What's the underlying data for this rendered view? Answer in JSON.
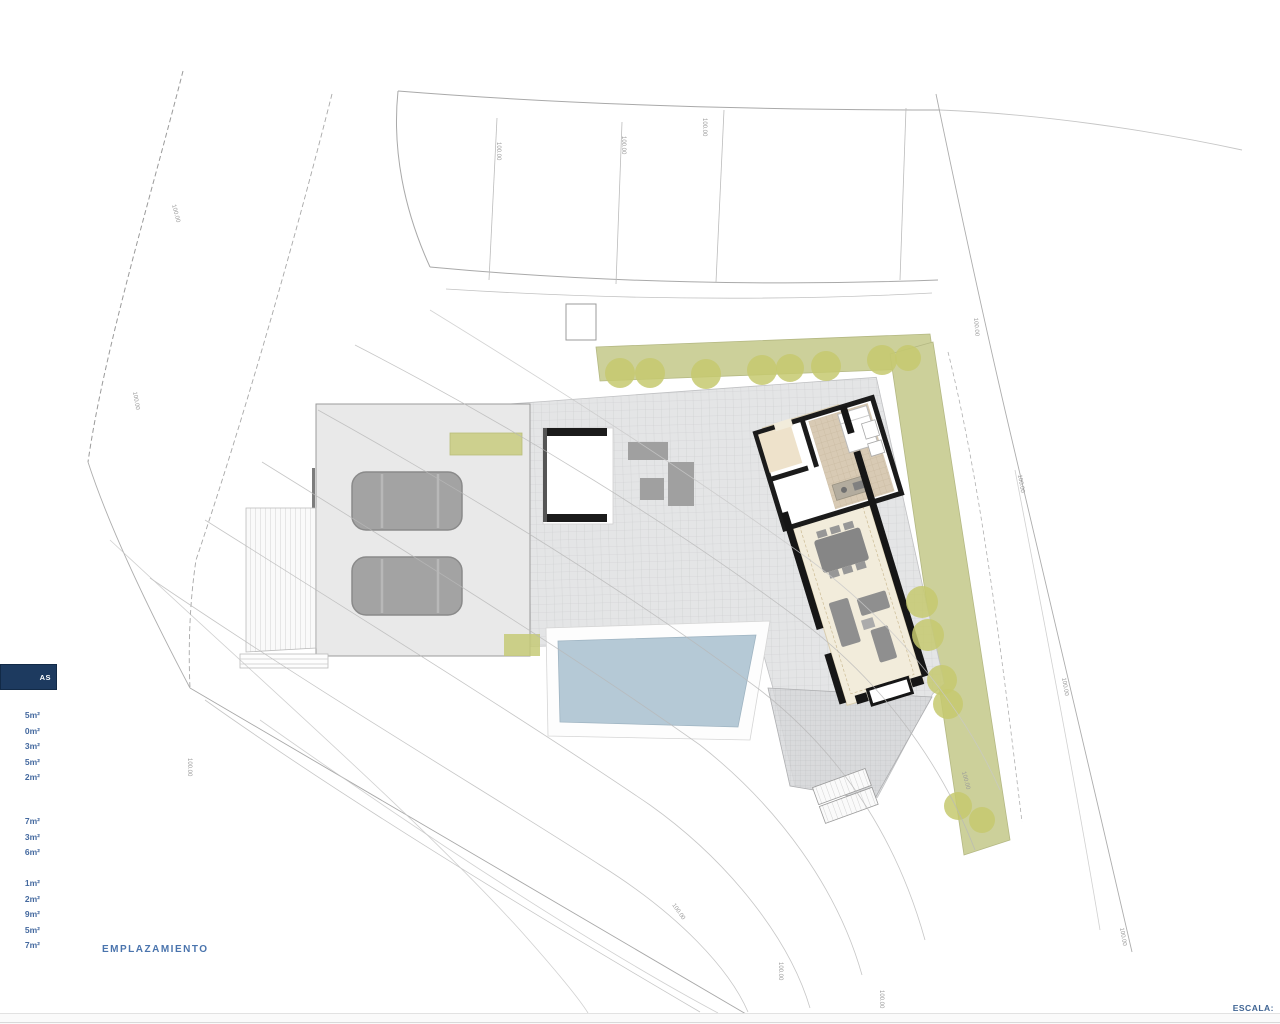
{
  "legend": {
    "title": "AS",
    "groups": [
      {
        "rows": [
          "5m²",
          "0m²",
          "3m²",
          "5m²",
          "2m²"
        ]
      },
      {
        "rows": [
          "7m²",
          "3m²",
          "6m²"
        ]
      },
      {
        "rows": [
          "1m²",
          "2m²",
          "9m²",
          "5m²",
          "7m²"
        ]
      }
    ]
  },
  "labels": {
    "plan_title": "EMPLAZAMIENTO",
    "scale": "ESCALA:"
  },
  "site": {
    "elevation_label": "100.00"
  },
  "colors": {
    "legend_navy": "#1d3a5f",
    "label_blue": "#4a74ad",
    "pool_blue": "#b5c9d6",
    "garden_green": "#ccd09a",
    "tree_olive": "#c5c96e",
    "terrace_cream": "#f2ecdb",
    "kitchen_tan": "#d8cab4",
    "wall_black": "#161616",
    "plaza_gray": "#e4e5e6",
    "car_gray": "#a3a3a3"
  }
}
